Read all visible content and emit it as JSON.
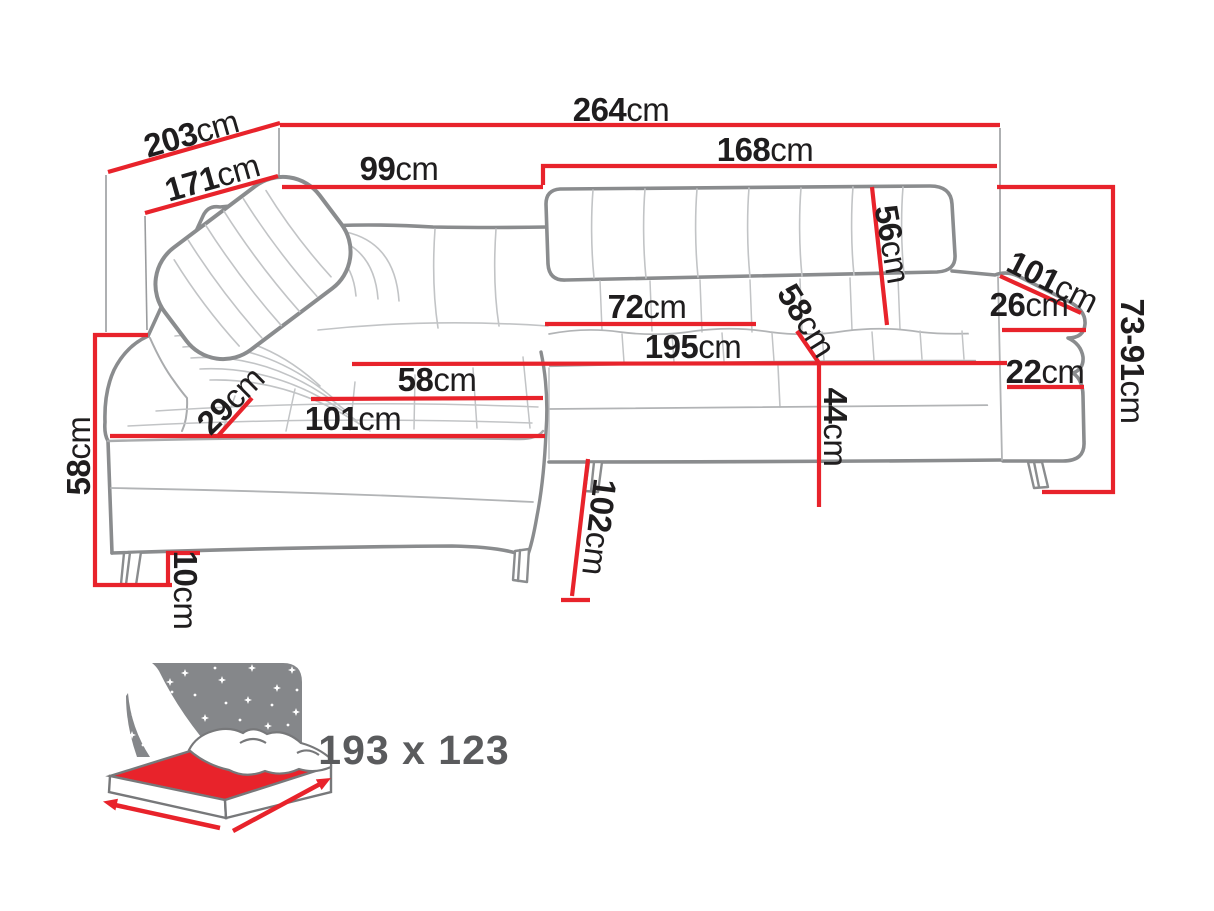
{
  "dimensions": {
    "d203": {
      "num": "203",
      "unit": "cm"
    },
    "d264": {
      "num": "264",
      "unit": "cm"
    },
    "d171": {
      "num": "171",
      "unit": "cm"
    },
    "d99": {
      "num": "99",
      "unit": "cm"
    },
    "d168": {
      "num": "168",
      "unit": "cm"
    },
    "d56": {
      "num": "56",
      "unit": "cm"
    },
    "d101r": {
      "num": "101",
      "unit": "cm"
    },
    "d26": {
      "num": "26",
      "unit": "cm"
    },
    "d7391": {
      "num": "73-91",
      "unit": "cm"
    },
    "d22": {
      "num": "22",
      "unit": "cm"
    },
    "d72": {
      "num": "72",
      "unit": "cm"
    },
    "d195": {
      "num": "195",
      "unit": "cm"
    },
    "d58d": {
      "num": "58",
      "unit": "cm"
    },
    "d44": {
      "num": "44",
      "unit": "cm"
    },
    "d58s": {
      "num": "58",
      "unit": "cm"
    },
    "d101c": {
      "num": "101",
      "unit": "cm"
    },
    "d29": {
      "num": "29",
      "unit": "cm"
    },
    "d58h": {
      "num": "58",
      "unit": "cm"
    },
    "d10": {
      "num": "10",
      "unit": "cm"
    },
    "d102": {
      "num": "102",
      "unit": "cm"
    }
  },
  "sleeping_area": {
    "size_label": "193 x 123"
  },
  "icons": {
    "sleeping_icon": "sleeping-function-bed-icon"
  },
  "colors": {
    "dimension_red": "#e8232b",
    "sofa_outline": "#8a8c8e",
    "sofa_seam": "#c2c4c6",
    "label_black": "#1f1d1e",
    "icon_gray": "#85878a",
    "icon_outline": "#77787a",
    "icon_label_gray": "#5a5b5d"
  }
}
